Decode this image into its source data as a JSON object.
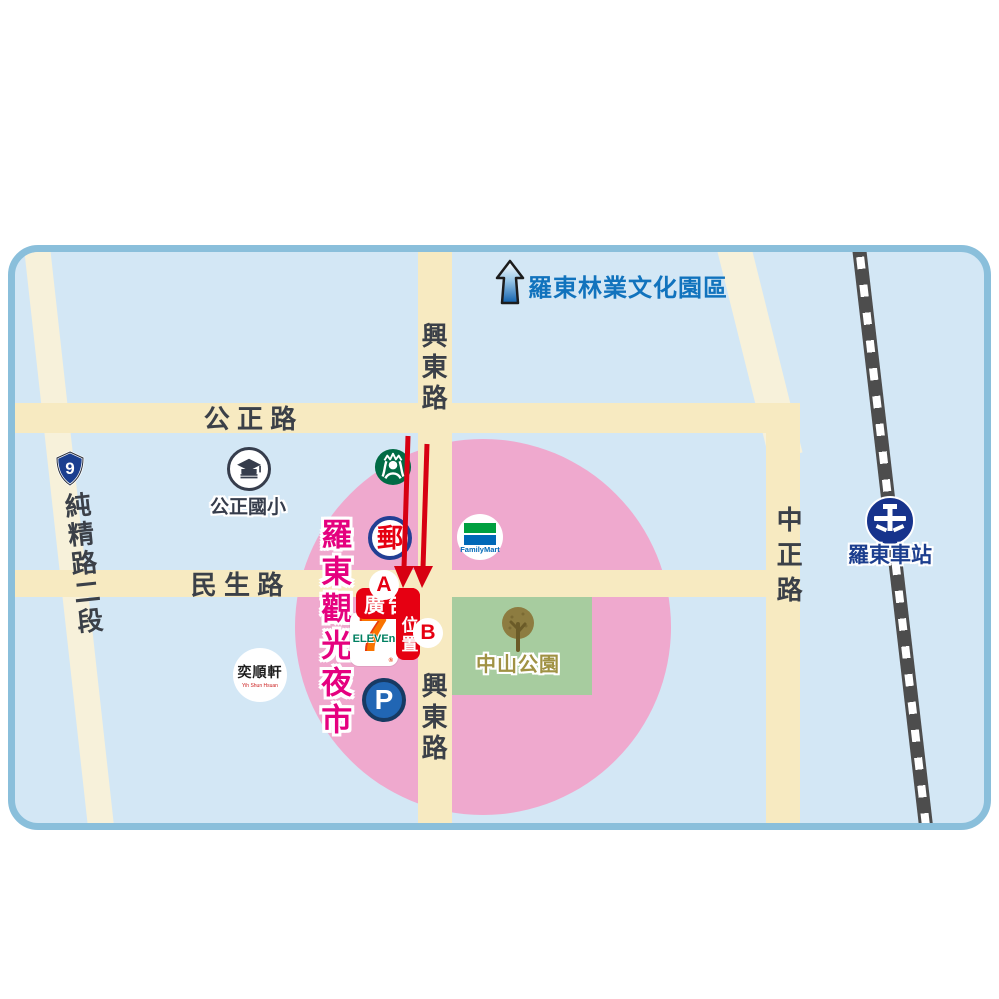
{
  "map": {
    "colors": {
      "water_bg": "#d3e7f5",
      "border": "#8abfdb",
      "road_main": "#f7eac1",
      "road_light": "#f7f1da",
      "night_market_zone_pink": "#efa9ce",
      "park_green": "#a7cc9f",
      "railway_dark": "#4d4d4d",
      "ad_red": "#e60012",
      "arrow_red": "#d70012",
      "forestry_text_blue": "#1173bd",
      "night_market_text_magenta": "#e5017f",
      "park_label_olive": "#a09244",
      "road_label_gray": "#3b4048",
      "station_text_blue": "#1c3e8e"
    },
    "labels": {
      "forestry_park": "羅東林業文化園區",
      "night_market": "羅東觀光夜市",
      "zhongshan_park": "中山公園",
      "station": "羅東車站",
      "school": "公正國小"
    },
    "roads": {
      "gongzheng": "公 正 路",
      "minsheng": "民 生 路",
      "xingdong_top": "興東路",
      "xingdong_bottom": "興東路",
      "chunjing": "純精路二段",
      "zhongzheng": "中正路"
    },
    "badges": {
      "highway_number": "9"
    },
    "stores": {
      "post_office_glyph": "郵",
      "familymart": "FamilyMart",
      "seven_eleven_digit": "7",
      "seven_eleven_word": "ELEVEn",
      "seven_eleven_reg": "®",
      "parking": "P",
      "bakery_name": "奕順軒",
      "bakery_sub": "Yih Shun Hsuan"
    },
    "ad": {
      "word_top": "廣告",
      "word_bottom": "位置",
      "marker_a": "A",
      "marker_b": "B"
    }
  }
}
